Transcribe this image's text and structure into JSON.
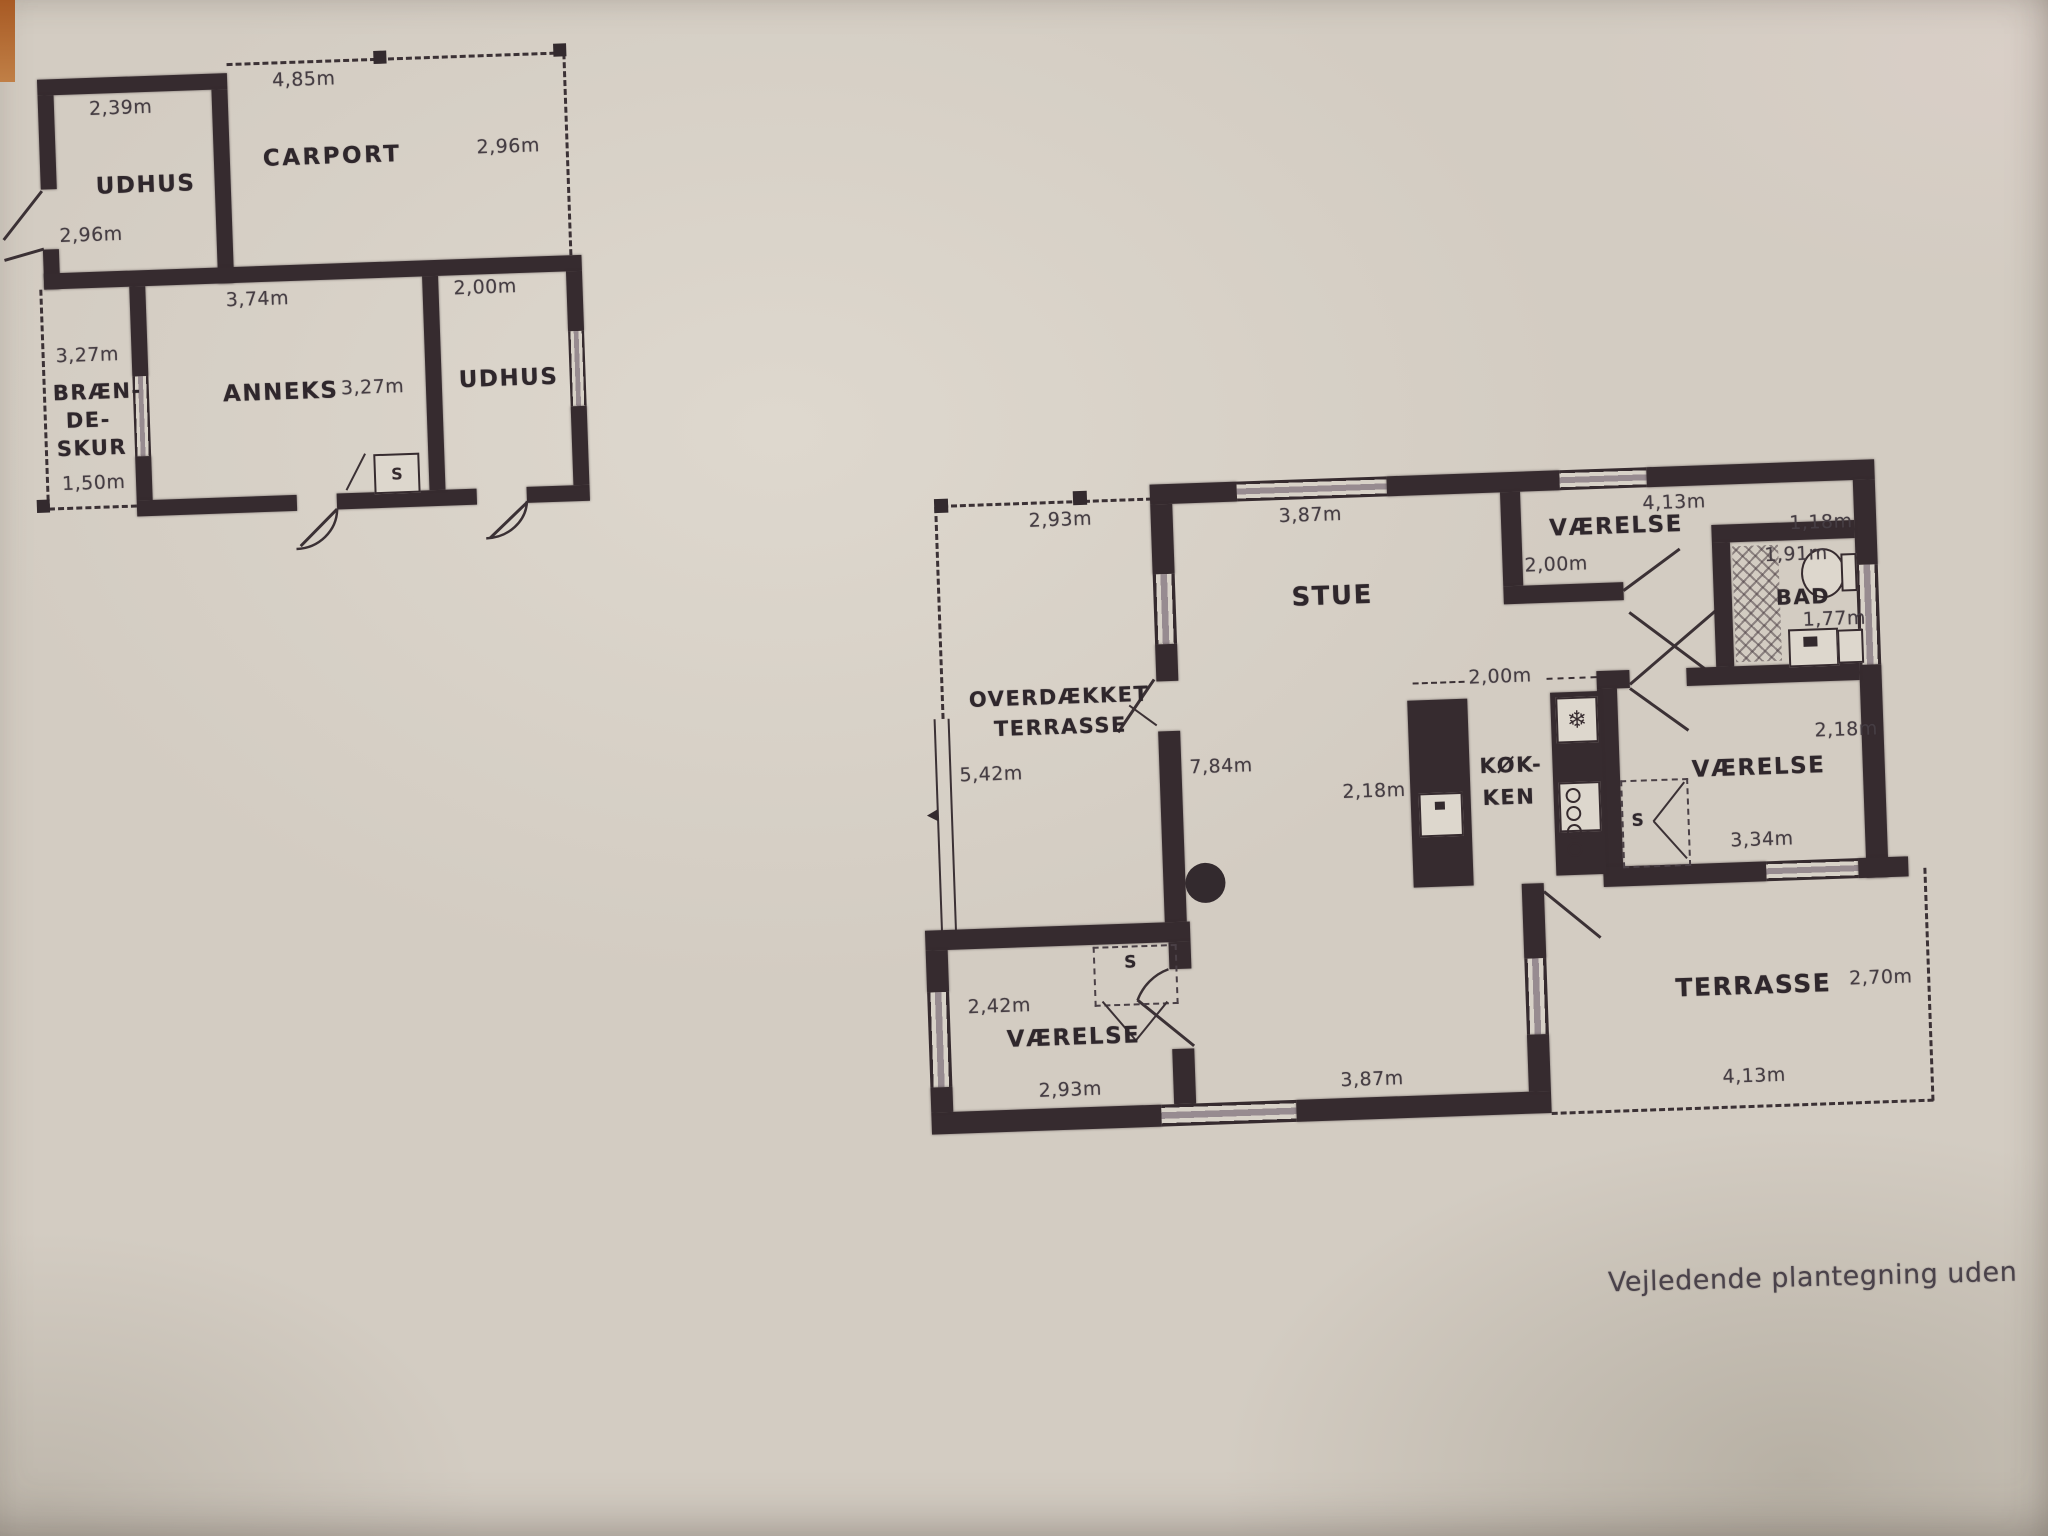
{
  "caption": "Vejledende plantegning uden",
  "colors": {
    "paper": "#d3ccc2",
    "wall": "#362b2f",
    "ink": "#453d43",
    "edge_accent": "#b06226"
  },
  "outbuilding": {
    "udhus_nw": {
      "label": "UDHUS",
      "dim_top": "2,39m",
      "dim_left": "2,96m"
    },
    "carport": {
      "label": "CARPORT",
      "dim_top": "4,85m",
      "dim_right": "2,96m"
    },
    "anneks": {
      "label": "ANNEKS",
      "dim_top": "3,74m",
      "dim_mid": "3,27m",
      "closet": "S"
    },
    "udhus_e": {
      "label": "UDHUS",
      "dim_top": "2,00m"
    },
    "braendeskur": {
      "line1": "BRÆN-",
      "line2": "DE-",
      "line3": "SKUR",
      "dim_top": "3,27m",
      "dim_bottom": "1,50m"
    }
  },
  "house": {
    "overdaekket": {
      "line1": "OVERDÆKKET",
      "line2": "TERRASSE",
      "dim_top": "2,93m",
      "dim_left": "5,42m"
    },
    "west_wall": {
      "dim": "7,84m"
    },
    "stue": {
      "label": "STUE",
      "dim_top": "3,87m",
      "dim_bottom": "3,87m"
    },
    "vaerelse_ne": {
      "label": "VÆRELSE",
      "dim_top": "4,13m",
      "dim_right": "1,18m",
      "dim_left": "2,00m"
    },
    "bad": {
      "label": "BAD",
      "dim_top": "1,91m",
      "dim_bottom": "1,77m"
    },
    "koekken": {
      "line1": "KØK-",
      "line2": "KEN",
      "dim_top": "2,00m",
      "dim_left": "2,18m"
    },
    "vaerelse_e": {
      "label": "VÆRELSE",
      "dim_top": "2,18m",
      "dim_bottom": "3,34m",
      "closet": "S"
    },
    "vaerelse_sw": {
      "label": "VÆRELSE",
      "dim_left": "2,42m",
      "dim_bottom": "2,93m",
      "closet": "S"
    },
    "terrasse": {
      "label": "TERRASSE",
      "dim_right": "2,70m",
      "dim_bottom": "4,13m"
    }
  }
}
